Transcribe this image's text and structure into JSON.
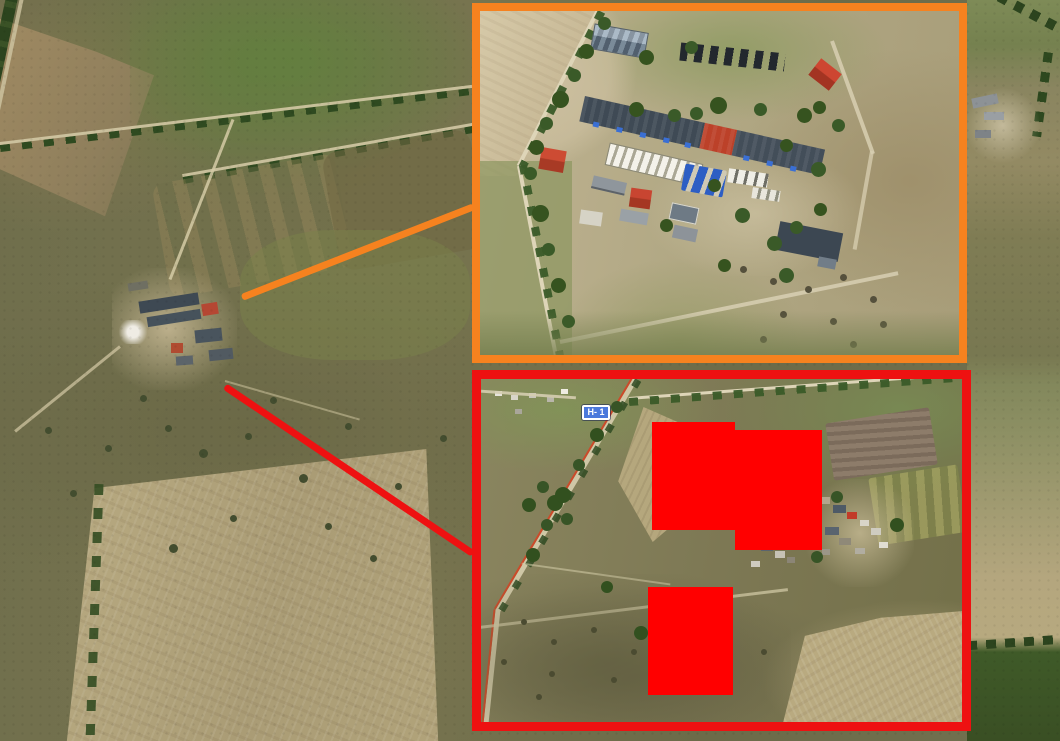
{
  "colors": {
    "orange_accent": "#F6821F",
    "red_accent": "#EE1111",
    "redaction_fill": "#FF0000",
    "sign_blue": "#4B79DC",
    "sign_border": "#FFFFFF"
  },
  "road_sign": {
    "label": "Н- 1"
  },
  "redactions": [
    {
      "x": 171,
      "y": 43,
      "w": 83,
      "h": 108
    },
    {
      "x": 254,
      "y": 51,
      "w": 87,
      "h": 120
    },
    {
      "x": 167,
      "y": 208,
      "w": 85,
      "h": 108
    }
  ]
}
